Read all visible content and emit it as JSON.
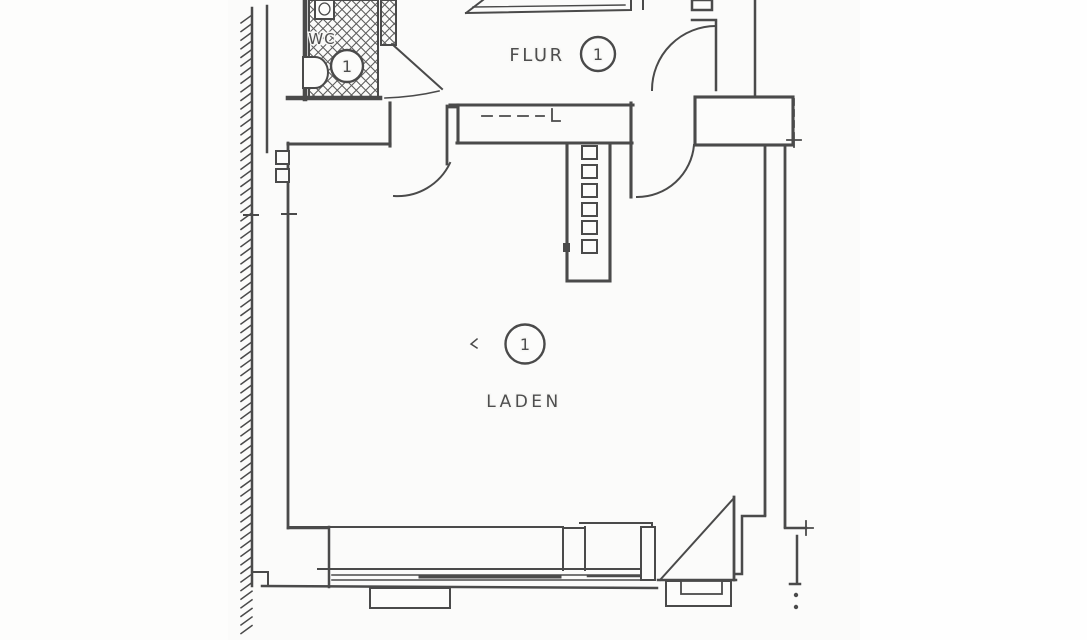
{
  "document": {
    "type_note": "scanned hand-drawn architectural floor plan",
    "colors": {
      "paper": "#fbfbfa",
      "paper_margin": "#ffffff",
      "line": "#4a4a4a",
      "hatch": "#5e5e5e",
      "text": "#4e4e4e"
    }
  },
  "rooms": {
    "wc": {
      "label": "WC",
      "number": "1"
    },
    "flur": {
      "label": "FLUR",
      "number": "1"
    },
    "laden": {
      "label": "LADEN",
      "number": "1"
    }
  }
}
